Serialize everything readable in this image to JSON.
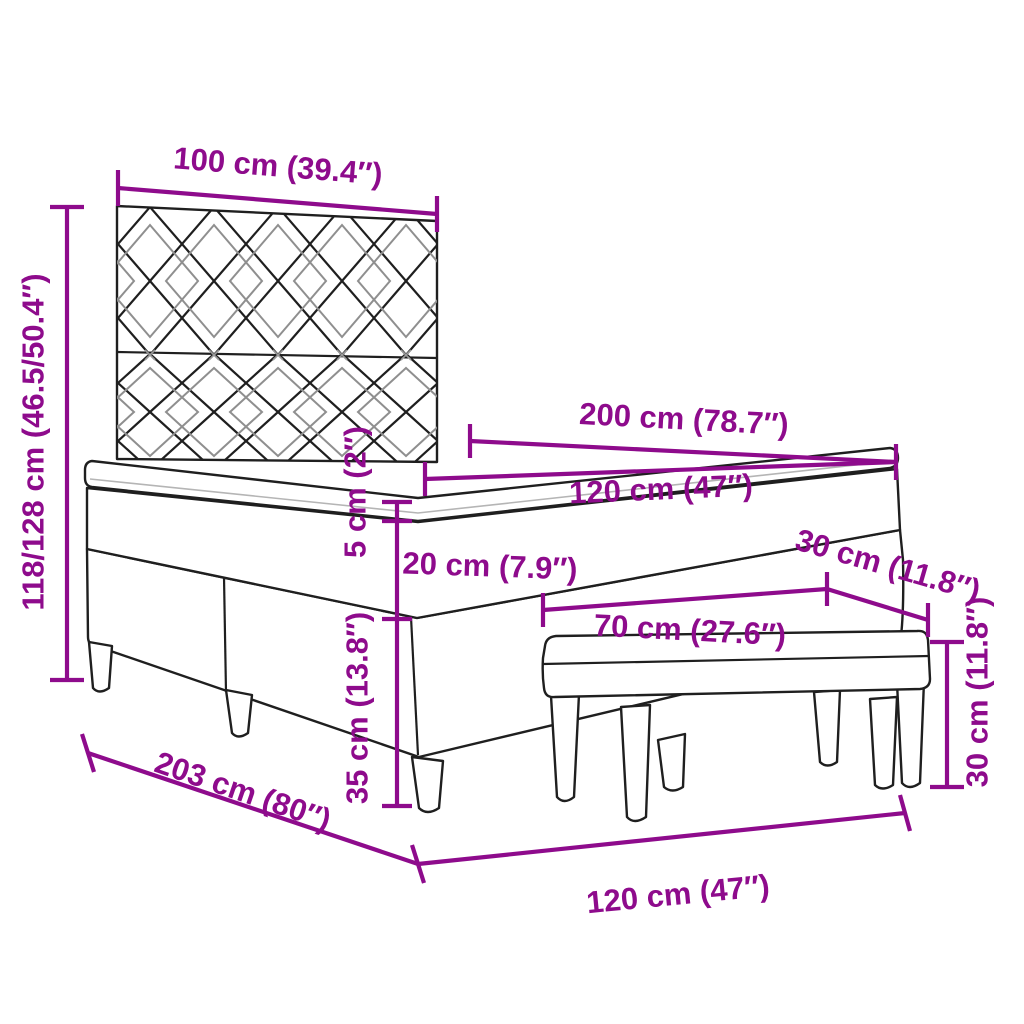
{
  "diagram": {
    "type": "furniture-dimension-diagram",
    "subject": "box-spring-bed-with-headboard-mattress-topper-and-bench",
    "background_color": "#ffffff",
    "accent_color": "#8E0B8C",
    "line_color": "#1f1f1f",
    "unit_primary": "cm",
    "unit_secondary": "inch",
    "dimensions": {
      "headboard_width": "100 cm (39.4″)",
      "overall_height": "118/128 cm (46.5/50.4″)",
      "bed_length": "200 cm (78.7″)",
      "mattress_width": "120 cm (47″)",
      "topper_height": "5 cm (2″)",
      "mattress_height": "20 cm (7.9″)",
      "frame_height": "35 cm (13.8″)",
      "bench_depth": "30 cm (11.8″)",
      "bench_length": "70 cm (27.6″)",
      "bench_height": "30 cm (11.8″)",
      "frame_length": "203 cm (80″)",
      "bed_width": "120 cm (47″)"
    }
  }
}
